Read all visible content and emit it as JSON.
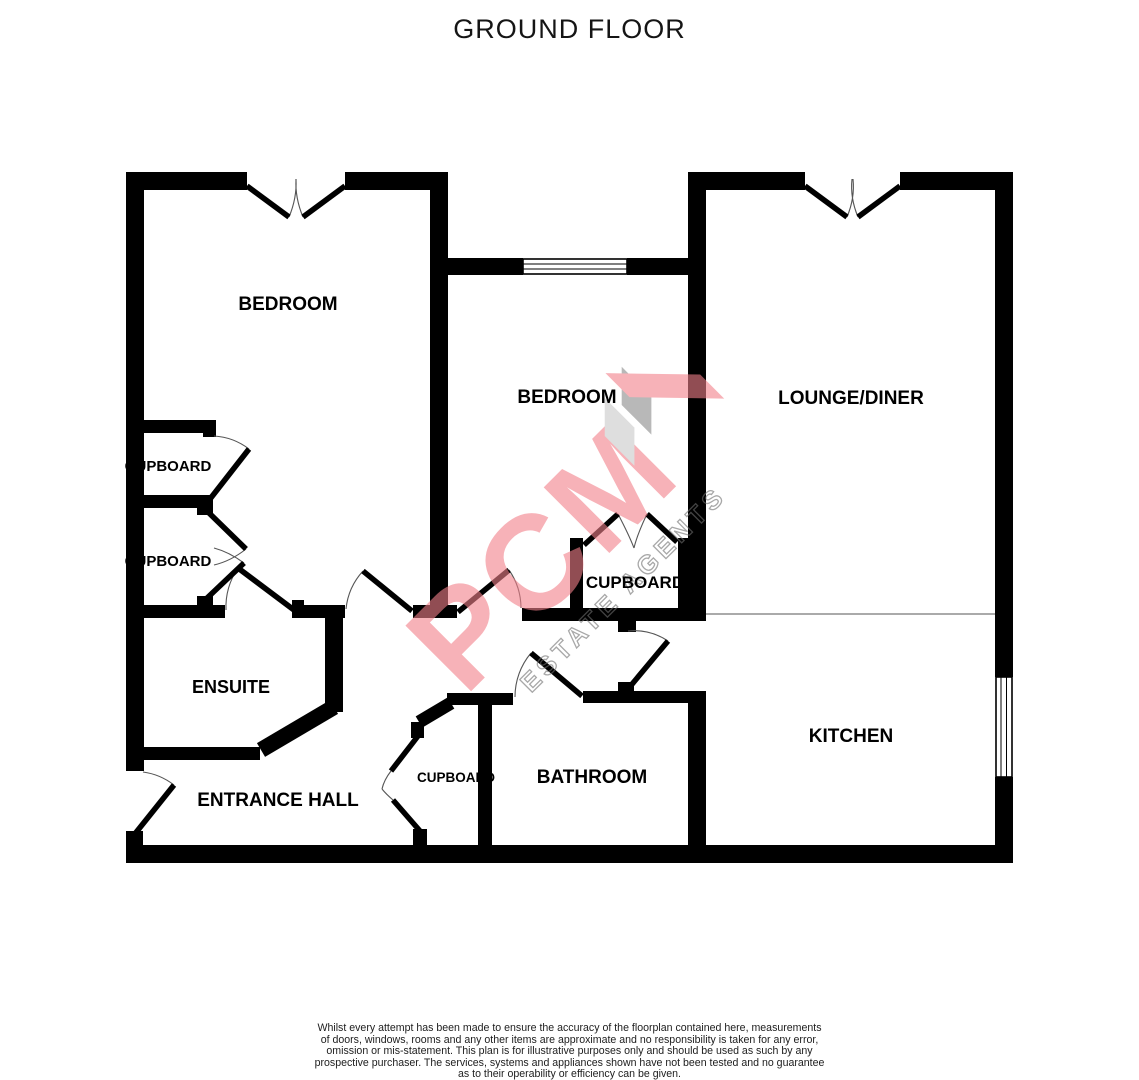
{
  "title": "GROUND FLOOR",
  "rooms": {
    "bedroom_top_left": "BEDROOM",
    "bedroom_middle": "BEDROOM",
    "lounge_diner": "LOUNGE/DINER",
    "kitchen": "KITCHEN",
    "bathroom": "BATHROOM",
    "entrance_hall": "ENTRANCE HALL",
    "ensuite": "ENSUITE",
    "cupboard_left_upper": "CUPBOARD",
    "cupboard_left_lower": "CUPBOARD",
    "cupboard_middle": "CUPBOARD",
    "cupboard_hall": "CUPBOARD"
  },
  "watermark": {
    "brand": "PCM",
    "tagline": "ESTATE AGENTS",
    "brand_color": "#f2808a",
    "stripe_light": "#c9c9c9",
    "stripe_dark": "#8a8a8a",
    "tagline_color": "#6f6f6f"
  },
  "colors": {
    "walls": "#000000",
    "background": "#ffffff",
    "door_arc": "#555555",
    "divider_line": "#777777"
  },
  "footer": {
    "disclaimer_lines": [
      "Whilst every attempt has been made to ensure the accuracy of the floorplan contained here, measurements",
      "of doors, windows, rooms and any other items are approximate and no responsibility is taken for any error,",
      "omission or mis-statement. This plan is for illustrative purposes only and should be used as such by any",
      "prospective purchaser. The services, systems and appliances shown have not been tested and no guarantee",
      "as to their operability or efficiency can be given.",
      "Made with Metropix ©2026"
    ]
  }
}
